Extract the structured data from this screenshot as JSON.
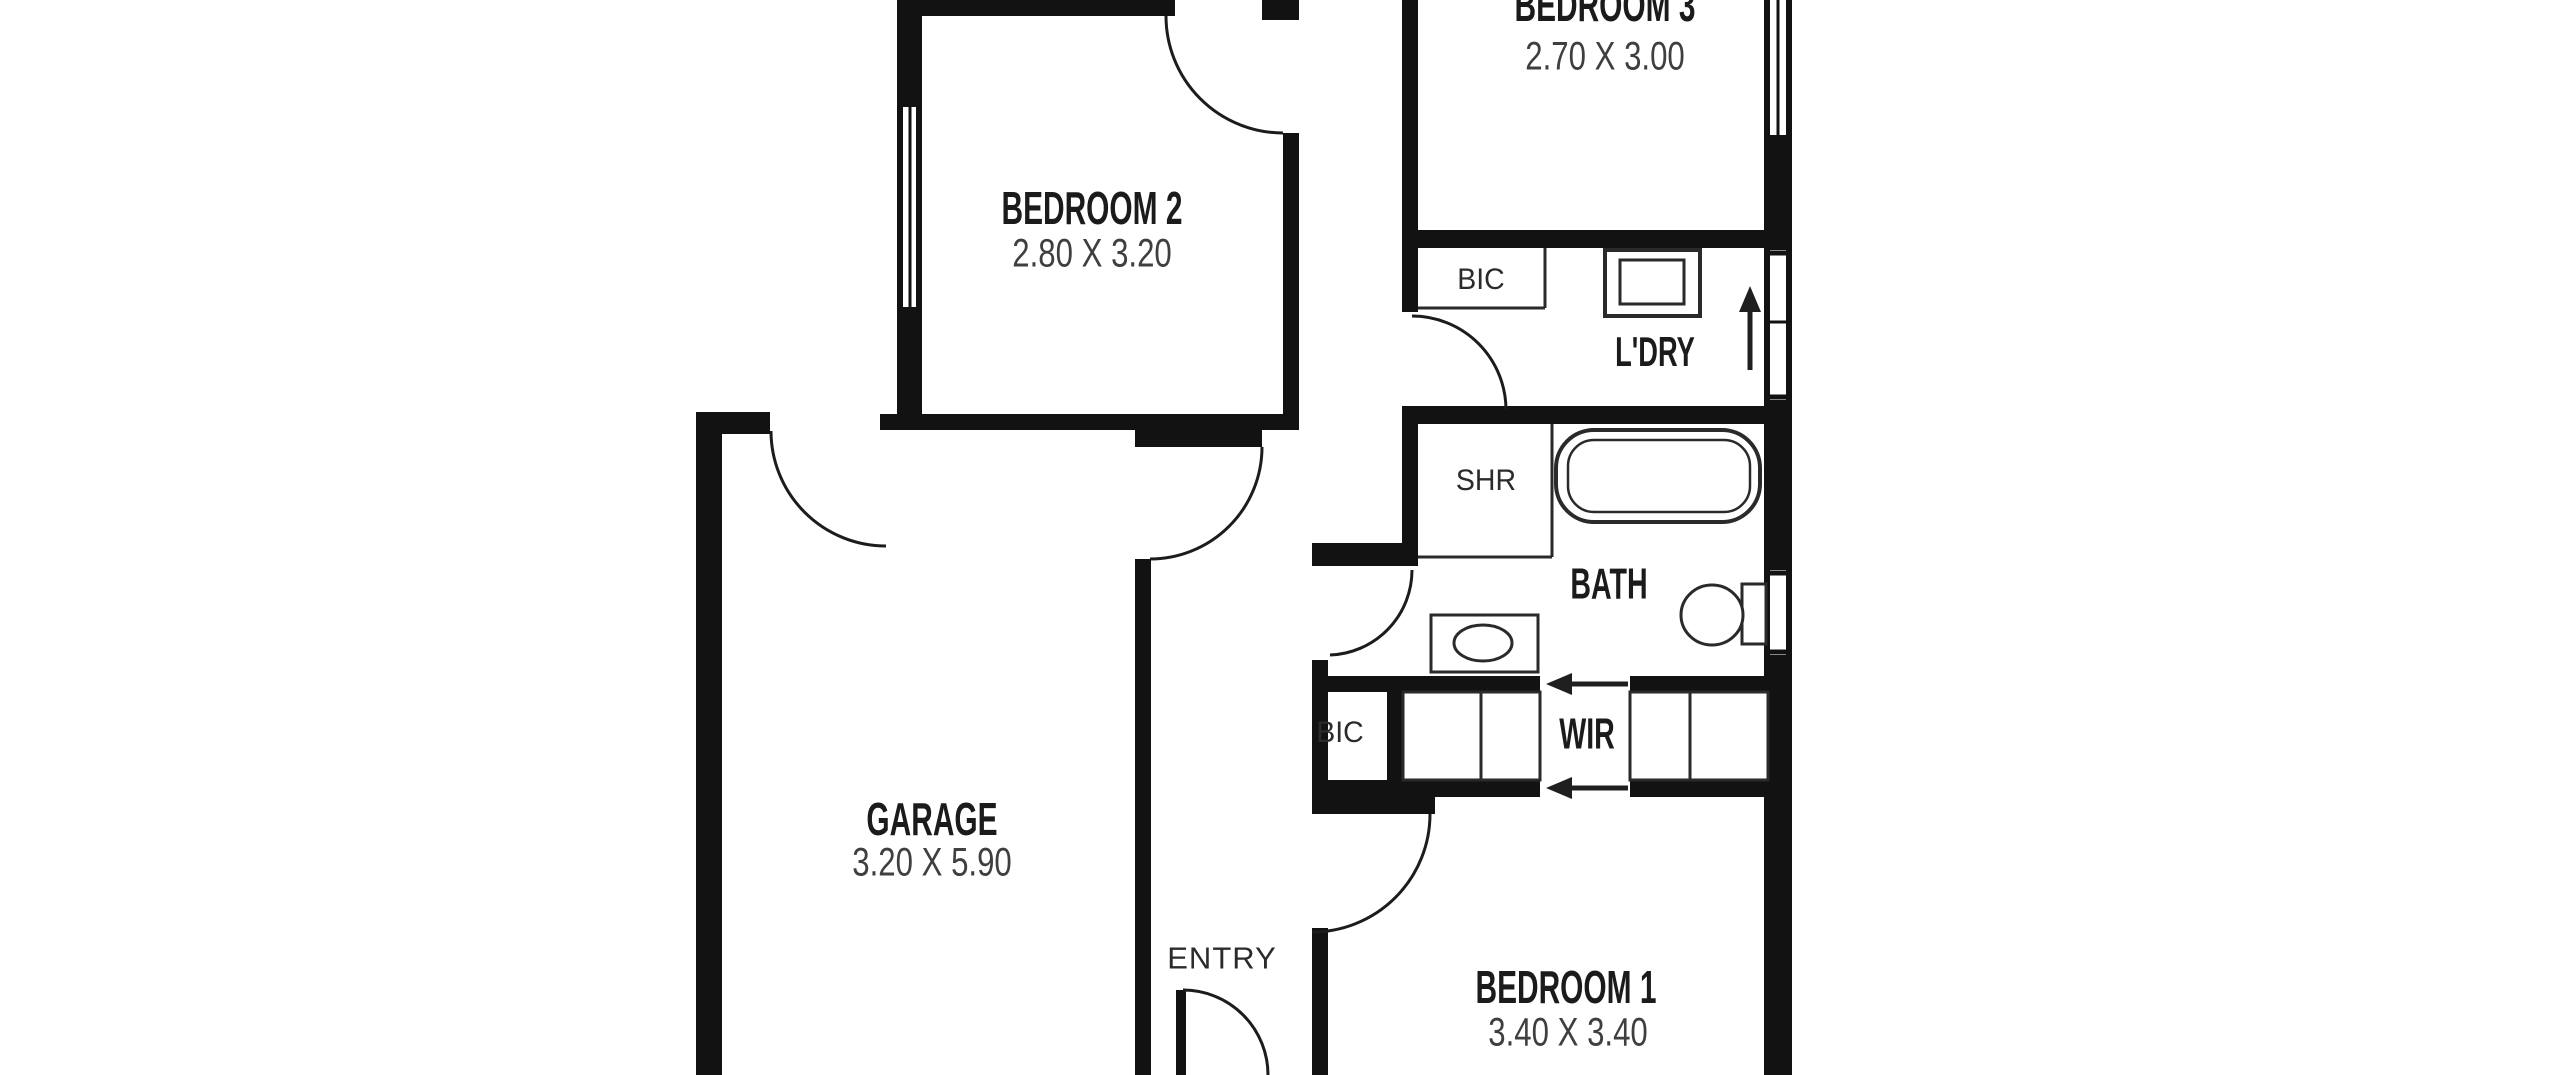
{
  "plan": {
    "rooms": [
      {
        "id": "bedroom3",
        "name": "BEDROOM 3",
        "dims": "2.70 X 3.00"
      },
      {
        "id": "bedroom2",
        "name": "BEDROOM 2",
        "dims": "2.80 X 3.20"
      },
      {
        "id": "garage",
        "name": "GARAGE",
        "dims": "3.20 X 5.90"
      },
      {
        "id": "bedroom1",
        "name": "BEDROOM 1",
        "dims": "3.40 X 3.40"
      },
      {
        "id": "bath",
        "name": "BATH"
      },
      {
        "id": "wir",
        "name": "WIR"
      },
      {
        "id": "laundry",
        "name": "L'DRY"
      }
    ],
    "labels": {
      "shower": "SHR",
      "bic_laundry": "BIC",
      "bic_wir": "BIC",
      "entry": "ENTRY"
    },
    "colors": {
      "background": "#ffffff",
      "wall": "#121212",
      "room_label": "#1b1b1b",
      "dim_label": "#3f3f3f",
      "small_label": "#2b2b2b",
      "fixture_stroke": "#2a2a2a"
    }
  }
}
